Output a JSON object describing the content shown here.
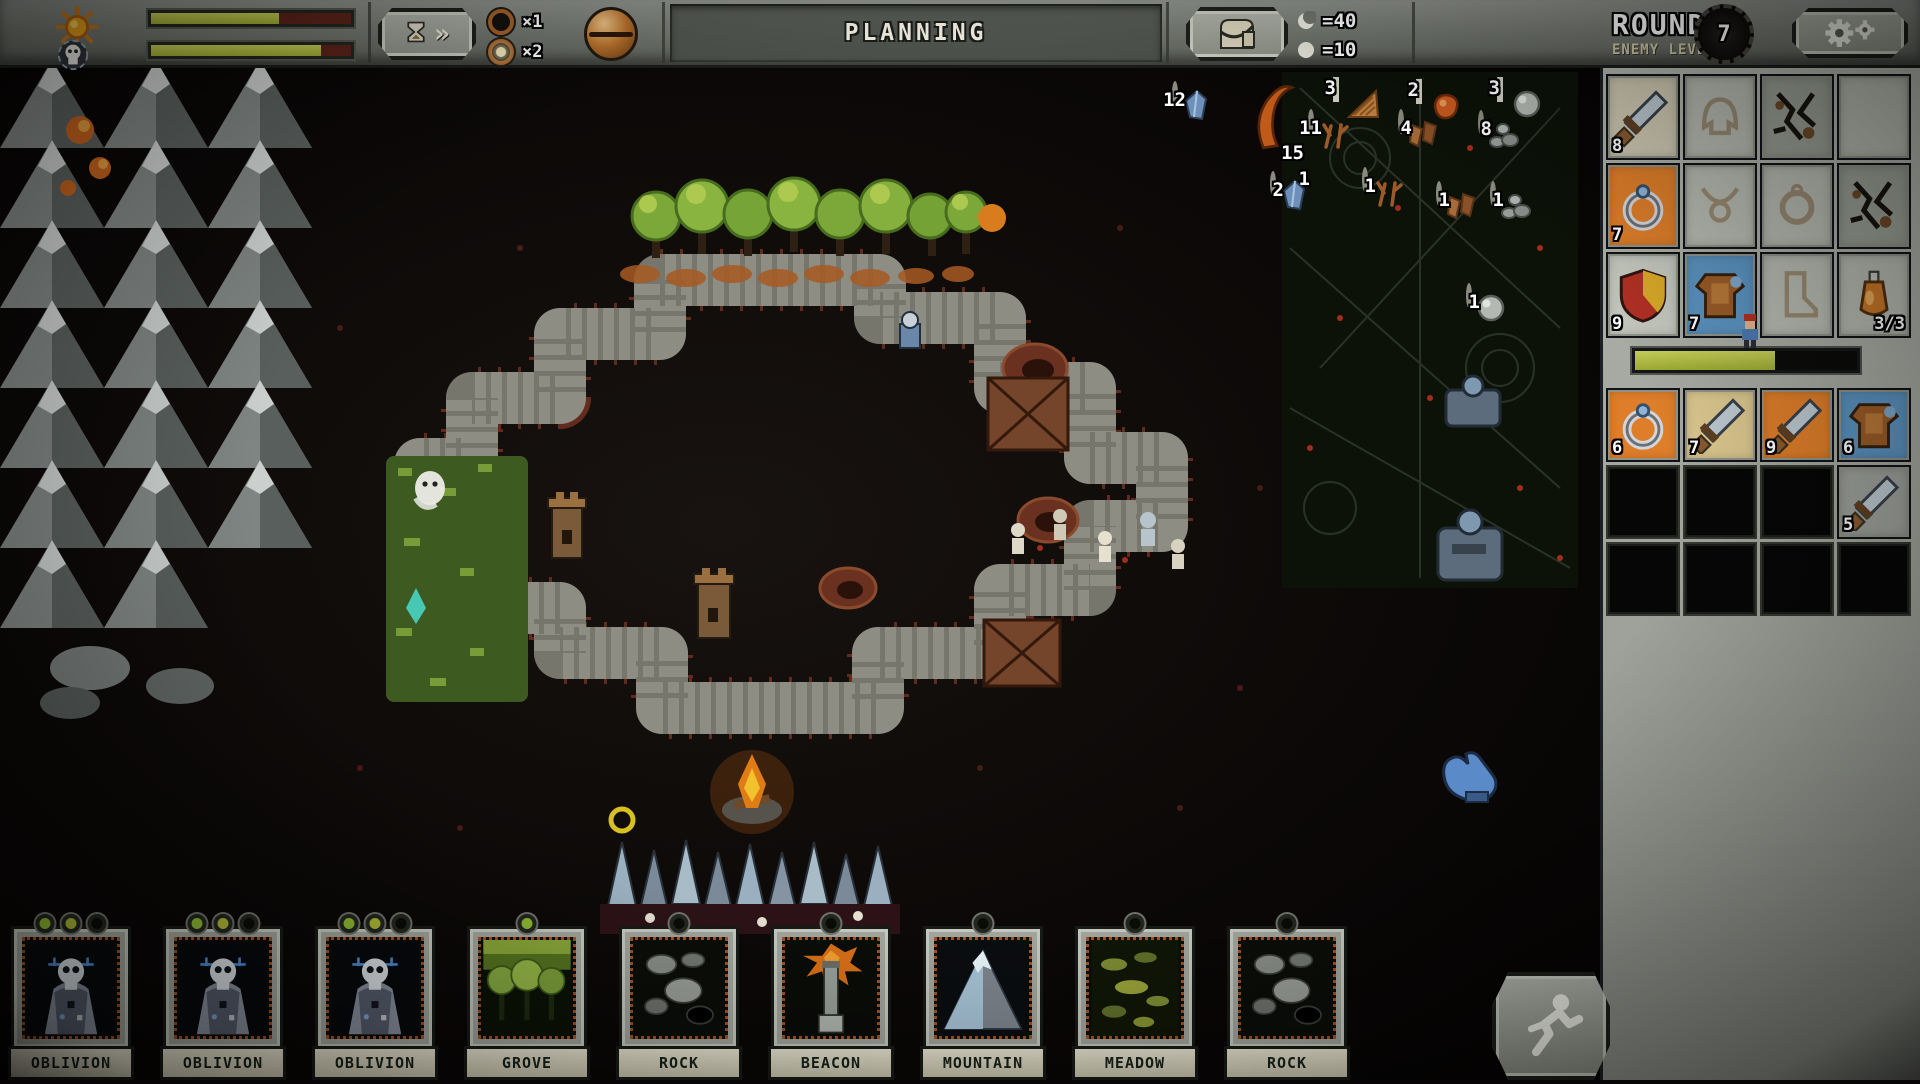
{
  "top_bar": {
    "day_meter": {
      "icon": "sun-icon",
      "fill_pct": 64
    },
    "boss_meter": {
      "icon": "skull-icon",
      "fill_pct": 85
    },
    "speed_button_glyph": "»",
    "speed_options": [
      {
        "label": "×1",
        "selected": false
      },
      {
        "label": "×2",
        "selected": true
      }
    ],
    "phase_title": "PLANNING",
    "time_counters": [
      {
        "icon": "moon-icon",
        "value": "=40"
      },
      {
        "icon": "day-orb-icon",
        "value": "=10"
      }
    ]
  },
  "round_panel": {
    "round_label": "ROUND",
    "enemy_level_label": "ENEMY LEVEL",
    "enemy_level_value": "7",
    "equipment_slots": [
      {
        "slot": "weapon",
        "item": "sword",
        "count": "8",
        "state": "filled",
        "bg": "#cfc9b2"
      },
      {
        "slot": "helmet",
        "item": "helmet",
        "state": "outline"
      },
      {
        "slot": "broken-1",
        "item": "cracks",
        "state": "cracked"
      },
      {
        "slot": "empty-1",
        "state": "plain"
      },
      {
        "slot": "ring",
        "item": "ring",
        "count": "7",
        "state": "filled",
        "bg": "#de7e2a"
      },
      {
        "slot": "amulet",
        "item": "amulet",
        "state": "outline"
      },
      {
        "slot": "ring-2",
        "item": "ringo",
        "state": "outline"
      },
      {
        "slot": "broken-2",
        "item": "cracks",
        "state": "cracked"
      },
      {
        "slot": "shield",
        "item": "shield",
        "count": "9",
        "state": "filled",
        "bg": "#c3c7bd"
      },
      {
        "slot": "armor",
        "item": "armor",
        "count": "7",
        "state": "filled",
        "bg": "#5b93c0"
      },
      {
        "slot": "boots",
        "item": "boot",
        "state": "outline"
      },
      {
        "slot": "potion",
        "item": "potion",
        "count": "3/3",
        "state": "filled",
        "bg": "#b6bab0",
        "count_side": "right"
      }
    ],
    "hp_bar": {
      "text": "722 / 1152",
      "fill_pct": 63
    },
    "loot_slots": [
      {
        "item": "ring",
        "count": "6",
        "bg": "#de7e2a"
      },
      {
        "item": "sword",
        "count": "7",
        "bg": "#dac68e"
      },
      {
        "item": "sword",
        "count": "9",
        "bg": "#de7e2a"
      },
      {
        "item": "armor",
        "count": "6",
        "bg": "#5b93c0"
      },
      {},
      {},
      {},
      {
        "item": "sword",
        "count": "5",
        "bg": "#9da19b"
      },
      {},
      {},
      {},
      {}
    ],
    "stats": {
      "title": "STATS",
      "rows": [
        {
          "label": "DAMAGE",
          "value": "34-52"
        },
        {
          "label": "MAX HP",
          "value": "+902"
        },
        {
          "label": "DAMAGE TO ALL",
          "value": "4"
        },
        {
          "label": "REGEN PER SEC",
          "value": "4.2"
        },
        {
          "label": "DEFENSE",
          "value": "31"
        },
        {
          "label": "ATTACK SPEED",
          "value": "+8%"
        },
        {
          "label": "COUNTER",
          "value": "+14%"
        },
        {
          "label": "HP PER DAY",
          "value": "+44"
        }
      ]
    }
  },
  "resources": [
    {
      "icon": "roof",
      "count": "3",
      "x": 1333,
      "y": 80,
      "framed": true
    },
    {
      "icon": "meat",
      "count": "2",
      "x": 1416,
      "y": 82,
      "framed": true
    },
    {
      "icon": "orb",
      "count": "3",
      "x": 1497,
      "y": 80,
      "framed": true
    },
    {
      "icon": "crystal",
      "count": "12",
      "x": 1172,
      "y": 84
    },
    {
      "icon": "horn",
      "count": "15",
      "x": 1252,
      "y": 78,
      "sub": "1",
      "bare": true
    },
    {
      "icon": "twigs",
      "count": "11",
      "x": 1308,
      "y": 112
    },
    {
      "icon": "rags",
      "count": "4",
      "x": 1398,
      "y": 112
    },
    {
      "icon": "pebbles",
      "count": "8",
      "x": 1478,
      "y": 113
    },
    {
      "icon": "crystal",
      "count": "2",
      "x": 1270,
      "y": 174
    },
    {
      "icon": "twigs",
      "count": "1",
      "x": 1362,
      "y": 170
    },
    {
      "icon": "rags",
      "count": "1",
      "x": 1436,
      "y": 184
    },
    {
      "icon": "pebbles",
      "count": "1",
      "x": 1490,
      "y": 184
    },
    {
      "icon": "orb",
      "count": "1",
      "x": 1466,
      "y": 286
    }
  ],
  "cards": [
    {
      "name": "OBLIVION",
      "art": "skull",
      "pips": [
        "green",
        "yellow",
        "dark"
      ]
    },
    {
      "name": "OBLIVION",
      "art": "skull",
      "pips": [
        "green",
        "yellow",
        "dark"
      ]
    },
    {
      "name": "OBLIVION",
      "art": "skull",
      "pips": [
        "green",
        "yellow",
        "dark"
      ]
    },
    {
      "name": "GROVE",
      "art": "grove",
      "pips": [
        "green"
      ]
    },
    {
      "name": "ROCK",
      "art": "rock",
      "pips": [
        "dark"
      ]
    },
    {
      "name": "BEACON",
      "art": "beacon",
      "pips": [
        "dark"
      ]
    },
    {
      "name": "MOUNTAIN",
      "art": "mountain",
      "pips": [
        "dark"
      ]
    },
    {
      "name": "MEADOW",
      "art": "meadow",
      "pips": [
        "dark"
      ]
    },
    {
      "name": "ROCK",
      "art": "rock",
      "pips": [
        "dark"
      ]
    }
  ]
}
